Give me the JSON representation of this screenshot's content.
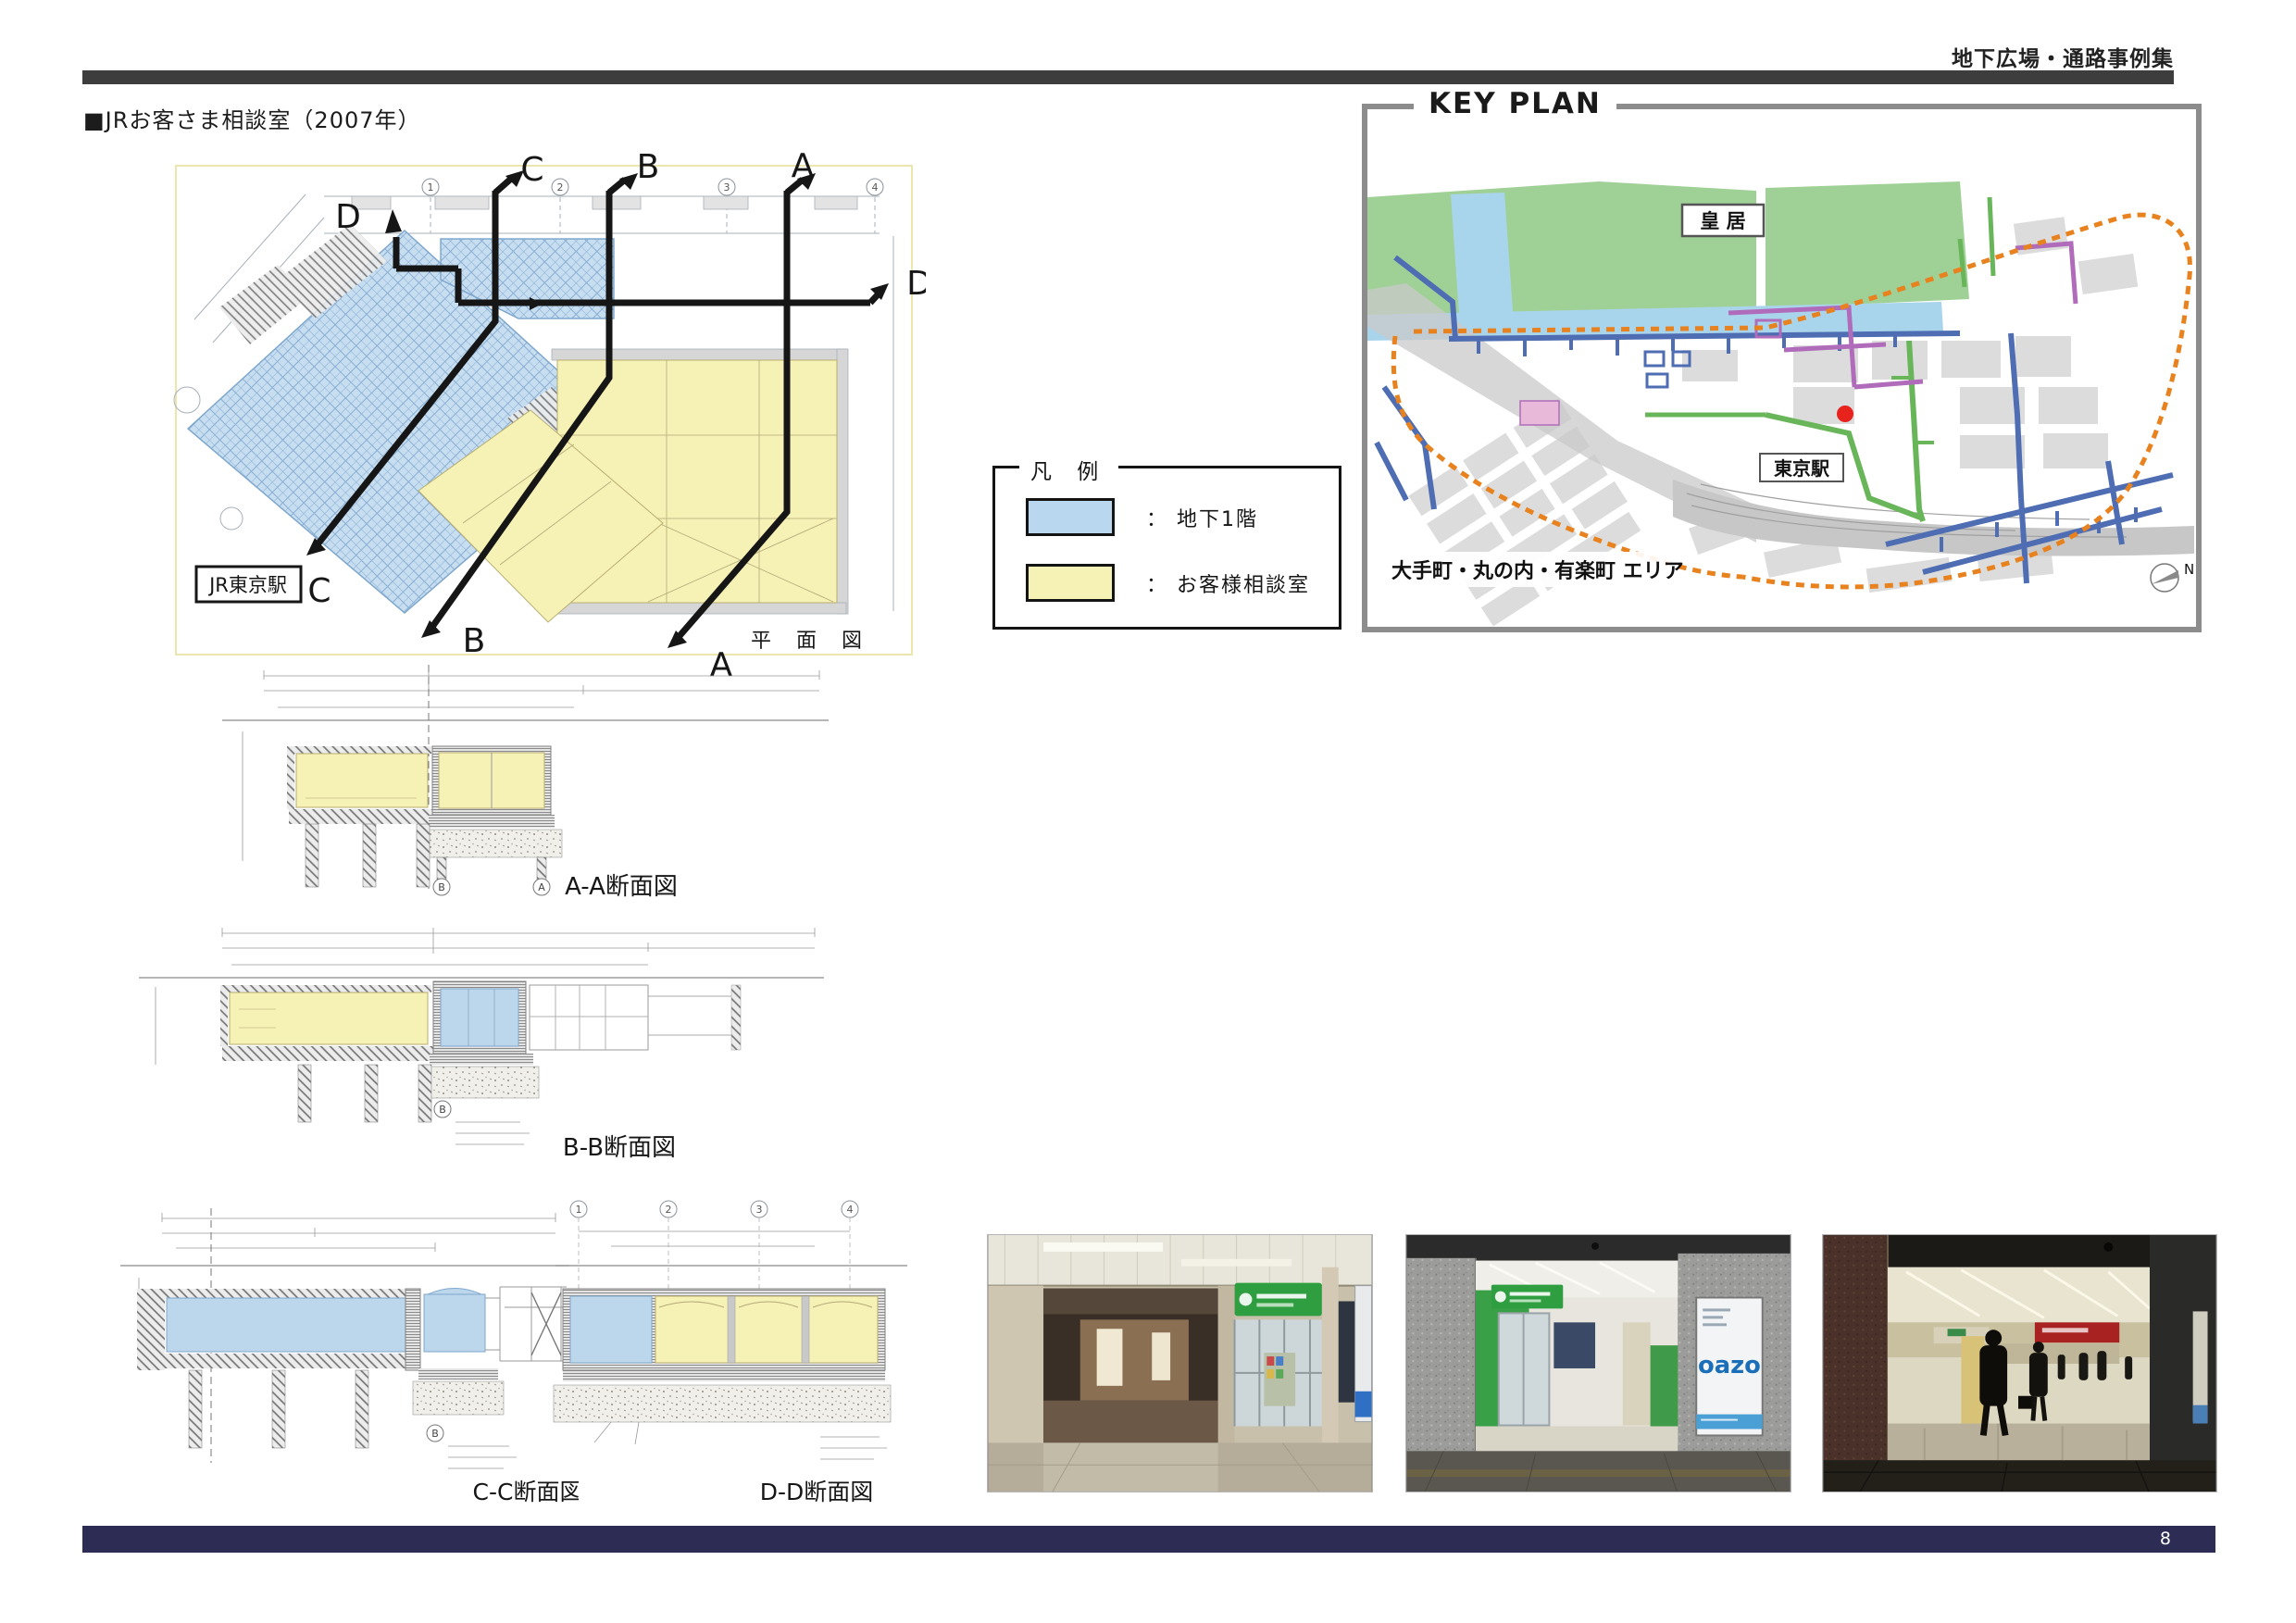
{
  "page": {
    "header_right": "地下広場・通路事例集",
    "title": "■JRお客さま相談室（2007年）",
    "page_number": "8"
  },
  "plan": {
    "caption": "平 面 図",
    "station_box_label": "JR東京駅",
    "section_letters": {
      "a": "A",
      "b": "B",
      "c": "C",
      "d": "D"
    },
    "grid_marks": [
      "1",
      "2",
      "3",
      "4"
    ]
  },
  "legend": {
    "title": "凡 例",
    "items": [
      {
        "swatch_color": "#b9d7ee",
        "colon": "：",
        "label": "地下1階"
      },
      {
        "swatch_color": "#f6f1b4",
        "colon": "：",
        "label": "お客様相談室"
      }
    ]
  },
  "key_plan": {
    "title": "KEY PLAN",
    "labels": {
      "imperial_palace": "皇 居",
      "tokyo_station": "東京駅",
      "area": "大手町・丸の内・有楽町 エリア",
      "north": "N"
    },
    "marker_color": "#e8231e"
  },
  "sections": {
    "aa_label": "A-A断面図",
    "bb_label": "B-B断面図",
    "cc_label": "C-C断面図",
    "dd_label": "D-D断面図",
    "aa_grid_marks": [
      "B",
      "A"
    ],
    "bb_grid_mark": "B",
    "cc_grid_mark": "B",
    "dd_grid_marks": [
      "1",
      "2",
      "3",
      "4"
    ]
  },
  "photos": {
    "oazo_poster_text": "oazo"
  },
  "colors": {
    "basement_fill": "#b9d7ee",
    "consult_room_fill": "#f6f1b4",
    "top_bar": "#3d3d3d",
    "footer_bar": "#2c2c55",
    "orange_boundary": "#e8821e",
    "corridor_blue": "#4e6db3",
    "corridor_green": "#69b55a",
    "corridor_purple": "#b06cba",
    "park_green": "#9fd196",
    "water_blue": "#a9d5ec"
  }
}
